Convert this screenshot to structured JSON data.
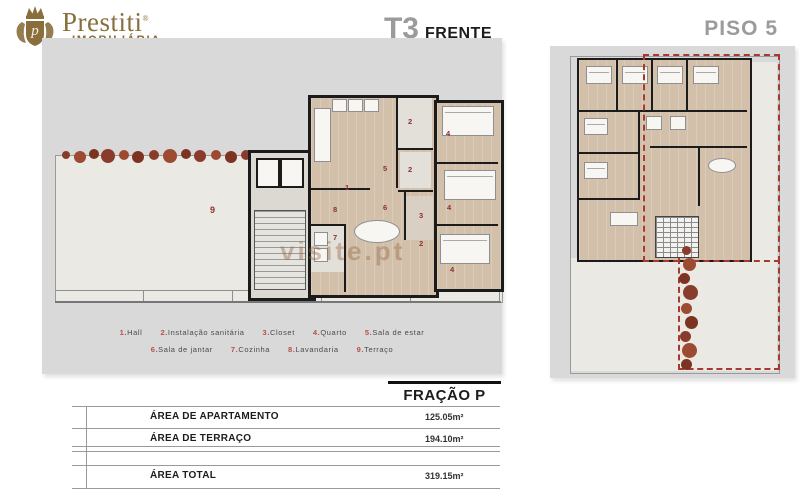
{
  "brand": {
    "name": "Prestiti",
    "reg": "®",
    "subtitle": "IMOBILIÁRIA",
    "monogram": "p"
  },
  "left_panel": {
    "title_main": "T3",
    "title_sub": "FRENTE",
    "watermark": "visite.pt",
    "room_markers": [
      "1",
      "2",
      "2",
      "2",
      "3",
      "4",
      "4",
      "4",
      "5",
      "6",
      "7",
      "8",
      "9"
    ],
    "legend_line1": [
      {
        "num": "1.",
        "name": "Hall"
      },
      {
        "num": "2.",
        "name": "Instalação sanitária"
      },
      {
        "num": "3.",
        "name": "Closet"
      },
      {
        "num": "4.",
        "name": "Quarto"
      },
      {
        "num": "5.",
        "name": "Sala de estar"
      }
    ],
    "legend_line2": [
      {
        "num": "6.",
        "name": "Sala de jantar"
      },
      {
        "num": "7.",
        "name": "Cozinha"
      },
      {
        "num": "8.",
        "name": "Lavandaria"
      },
      {
        "num": "9.",
        "name": "Terraço"
      }
    ]
  },
  "right_panel": {
    "title": "PISO 5"
  },
  "fraction": {
    "title": "FRAÇÃO P"
  },
  "area_table": {
    "rows": [
      {
        "label": "ÁREA DE APARTAMENTO",
        "value": "125.05m²"
      },
      {
        "label": "ÁREA DE TERRAÇO",
        "value": "194.10m²"
      },
      {
        "label": "ÁREA TOTAL",
        "value": "319.15m²"
      }
    ]
  },
  "colors": {
    "brand_gold": "#8a6f3c",
    "panel_gray": "#d9d9d9",
    "title_gray": "#9b9b9b",
    "legend_red": "#b5504a",
    "dash_red": "#a63a2e"
  }
}
